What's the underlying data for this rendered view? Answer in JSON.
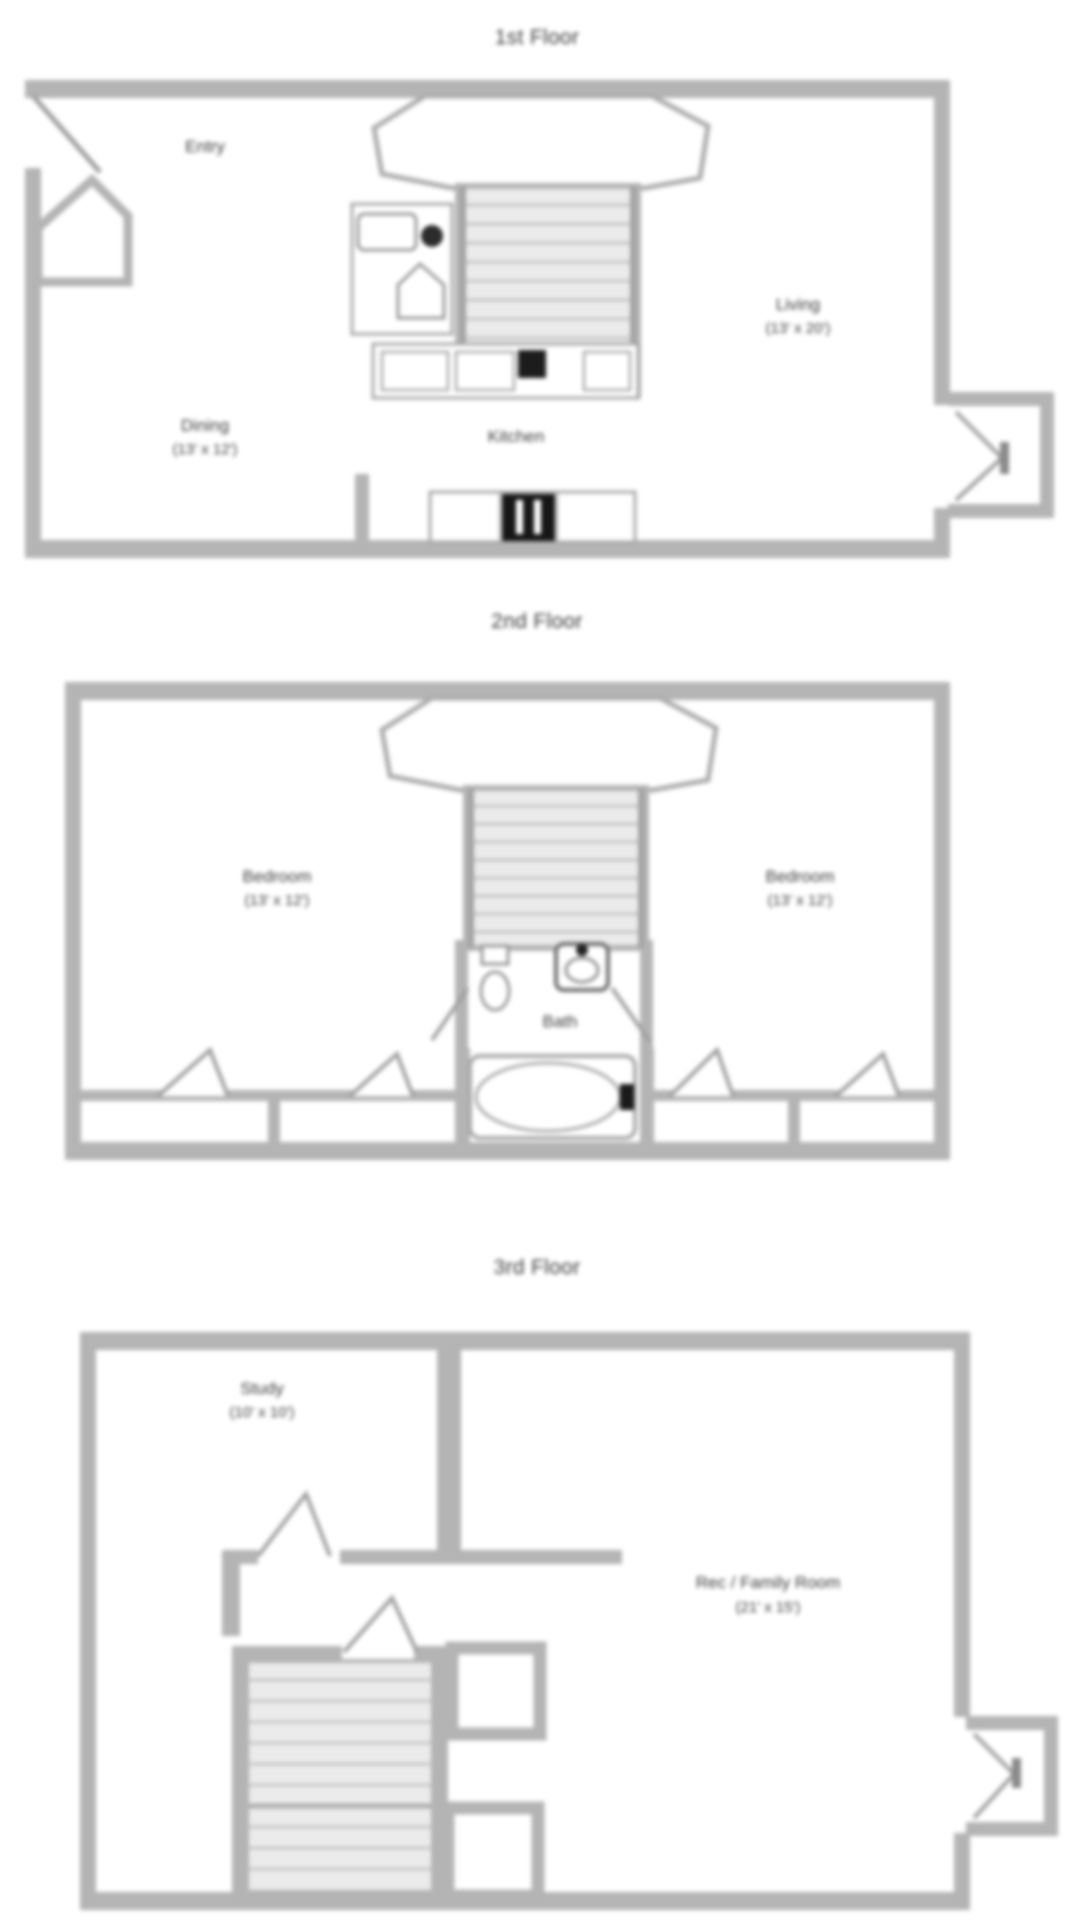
{
  "document": {
    "type": "floor-plan-sheet",
    "background": "#ffffff"
  },
  "colors": {
    "wall": "#b4b4b4",
    "thin_line": "#a0a0a0",
    "fixture_stroke": "#969696",
    "stair_fill": "#ebebeb",
    "stair_tread": "#c6c6c6",
    "appliance_black": "#161616",
    "text": "#3c3c3c"
  },
  "floors": [
    {
      "title": "1st Floor",
      "rooms": [
        {
          "name": "Entry",
          "dims": ""
        },
        {
          "name": "Living",
          "dims": "(13' x 20')"
        },
        {
          "name": "Dining",
          "dims": "(13' x 12')"
        },
        {
          "name": "Kitchen",
          "dims": ""
        }
      ]
    },
    {
      "title": "2nd Floor",
      "rooms": [
        {
          "name": "Bedroom",
          "dims": "(13' x 12')"
        },
        {
          "name": "Bedroom",
          "dims": "(13' x 12')"
        },
        {
          "name": "Bath",
          "dims": ""
        }
      ]
    },
    {
      "title": "3rd Floor",
      "rooms": [
        {
          "name": "Study",
          "dims": "(10' x 10')"
        },
        {
          "name": "Rec / Family Room",
          "dims": "(21' x 15')"
        }
      ]
    }
  ]
}
